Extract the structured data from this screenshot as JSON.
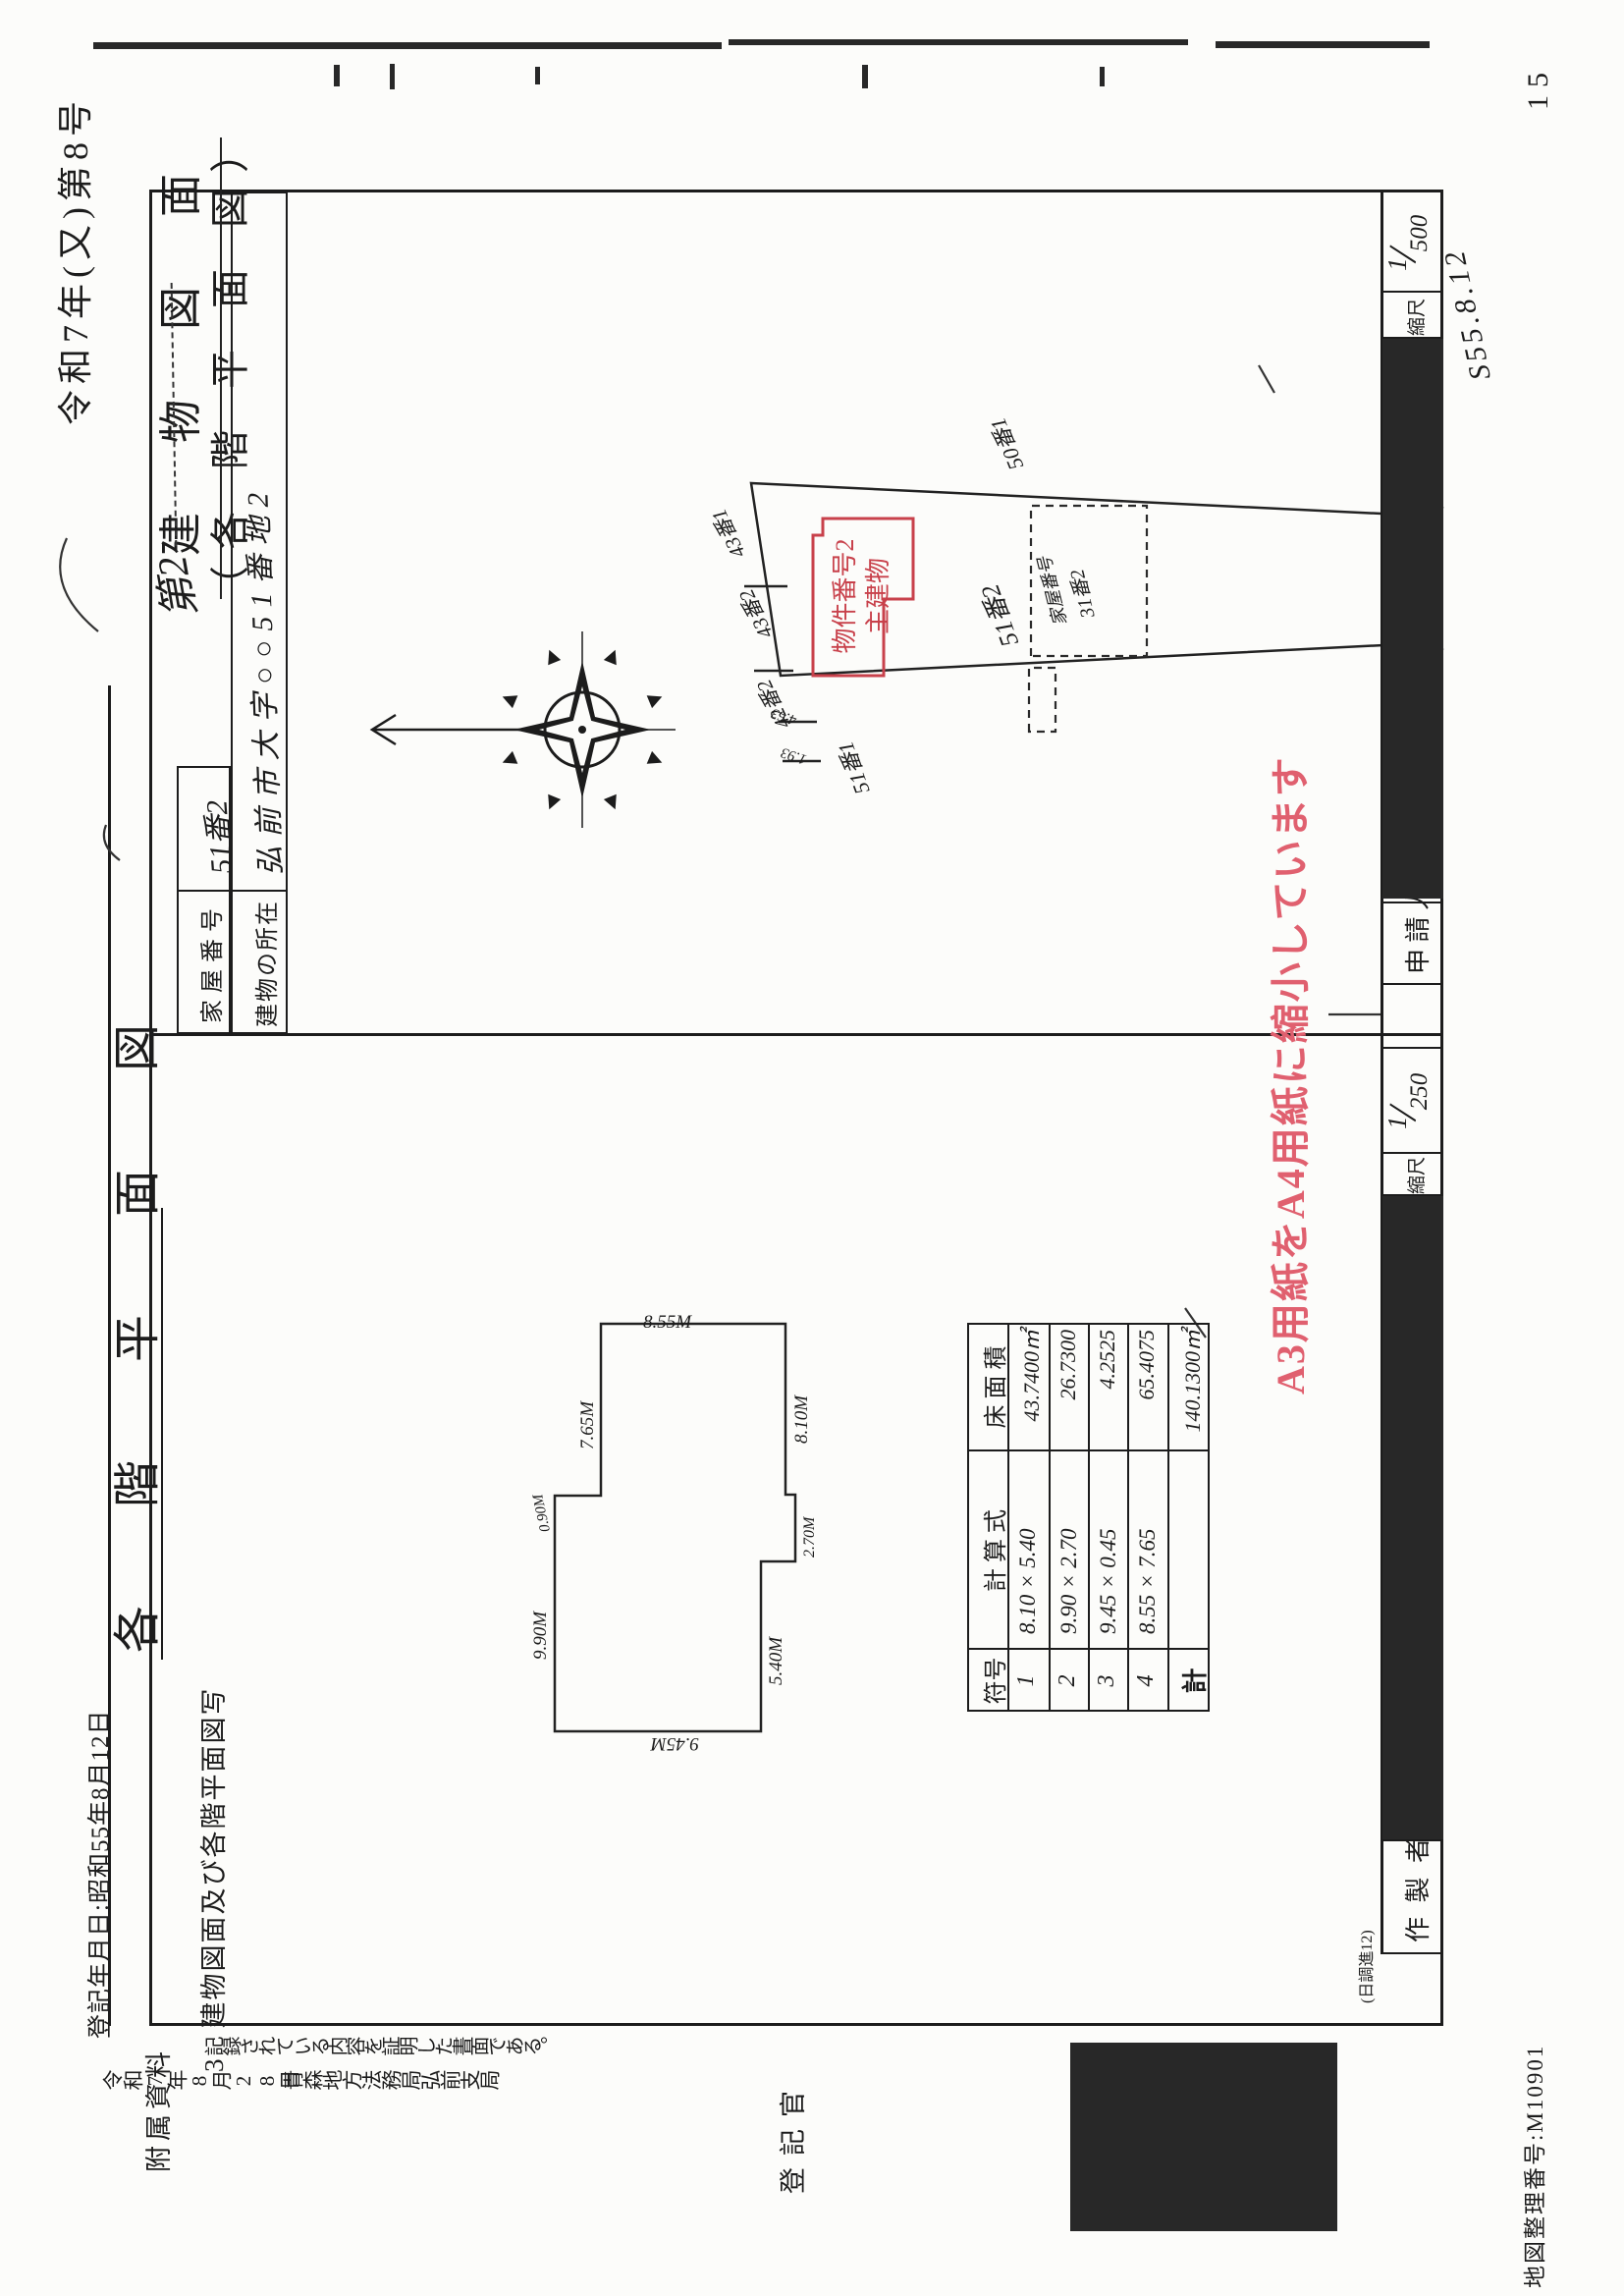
{
  "colors": {
    "accent_red": "#c8414b",
    "stamp_pink": "#e0606f",
    "ink": "#1c1c1c"
  },
  "header": {
    "case_no": "令和7年(又)第8号",
    "title_hand_prefix": "第2",
    "title_main": "建 物 図 面",
    "title_paren": "（各 階 平 面 図）",
    "section_heading": "各 階 平 面 図"
  },
  "info_table": {
    "rows": [
      {
        "label": "家屋番号",
        "value": "51番2"
      },
      {
        "label": "建物の所在",
        "value": "弘前市大字○○51番地2"
      }
    ]
  },
  "site_plan": {
    "lots": {
      "north": "50番1",
      "nw1": "43番1",
      "nw2": "43番2",
      "nw3": "42番2",
      "subject": "51番2",
      "sw": "51番1",
      "se": "53番2"
    },
    "boundary_dims": [
      "4.63",
      "1.93"
    ],
    "main_building": {
      "line1": "物件番号2",
      "line2": "主建物"
    },
    "annex_building": {
      "line1": "家屋番号",
      "line2": "31番2"
    }
  },
  "floor_plan": {
    "dims": {
      "top_left": "9.90M",
      "step": "0.90M",
      "top_right": "7.65M",
      "right": "8.55M",
      "bottom_right": "8.10M",
      "jog": "2.70M",
      "bottom_left": "5.40M",
      "left": "9.45M"
    }
  },
  "calc_table": {
    "headers": [
      "符号",
      "計 算 式",
      "床 面 積"
    ],
    "rows": [
      [
        "1",
        "8.10 × 5.40",
        "43.7400㎡"
      ],
      [
        "2",
        "9.90 × 2.70",
        "26.7300"
      ],
      [
        "3",
        "9.45 × 0.45",
        "4.2525"
      ],
      [
        "4",
        "8.55 × 7.65",
        "65.4075"
      ]
    ],
    "total_label": "計",
    "total_value": "140.1300㎡"
  },
  "bottom_row": {
    "maker_label": "作 製 者",
    "applicant_label": "申 請 人",
    "scale_label_left": "縮尺",
    "scale_left_num": "1",
    "scale_left_den": "250",
    "scale_label_right": "縮尺",
    "scale_right_num": "1",
    "scale_right_den": "500",
    "hand_date": "S55.8.12",
    "form_note": "(日調進12)"
  },
  "certification": {
    "reg_date_line": "登記年月日:昭和55年8月12日",
    "attach_label": "附属資料",
    "attach_value": "3　建物図面及び各階平面図写",
    "cert_text": "記録されている内容を証明した書面である。",
    "cert_date": "令和7年8月28日",
    "cert_office": "青森地方法務局弘前支局",
    "officer_label": "登記官"
  },
  "stamps": {
    "a3_note": "A3用紙をA4用紙に縮小しています"
  },
  "footer": {
    "map_no": "地図整理番号:M10901",
    "page_no": "15"
  }
}
